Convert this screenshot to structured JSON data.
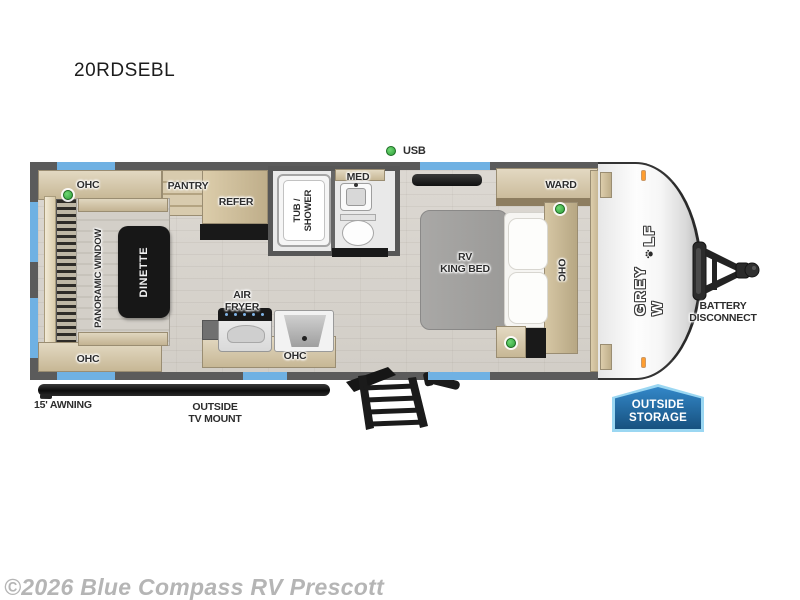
{
  "page": {
    "model": "20RDSEBL",
    "watermark": "©2026 Blue Compass RV Prescott"
  },
  "plan": {
    "usb": "USB",
    "ohc": "OHC",
    "pantry": "PANTRY",
    "panoramic_window": "PANORAMIC WINDOW",
    "dinette": "DINETTE",
    "refer": "REFER",
    "med": "MED",
    "tub_shower": {
      "line1": "TUB /",
      "line2": "SHOWER"
    },
    "air_fryer": {
      "line1": "AIR",
      "line2": "FRYER"
    },
    "ward": "WARD",
    "king_bed": {
      "line1": "RV",
      "line2": "KING BED"
    },
    "awning": "15' AWNING",
    "tv_mount": {
      "line1": "OUTSIDE",
      "line2": "TV MOUNT"
    },
    "battery": {
      "line1": "BATTERY",
      "line2": "DISCONNECT"
    },
    "storage": {
      "line1": "OUTSIDE",
      "line2": "STORAGE"
    },
    "logo": {
      "prefix": "GREY W",
      "suffix": "LF",
      "paw": "paw-print"
    }
  },
  "colors": {
    "window_blue": "#6fb1e3",
    "indicator_green": "#3fb54a",
    "storage_badge_fill": "#2478bd",
    "storage_badge_border": "#9bd7f2",
    "marker_light_orange": "#ff9d2e",
    "wall_gray": "#5b5b5b",
    "wood_tan": "#d2c3a3",
    "floor": "#d7d3cc",
    "awning_black": "#141414"
  }
}
